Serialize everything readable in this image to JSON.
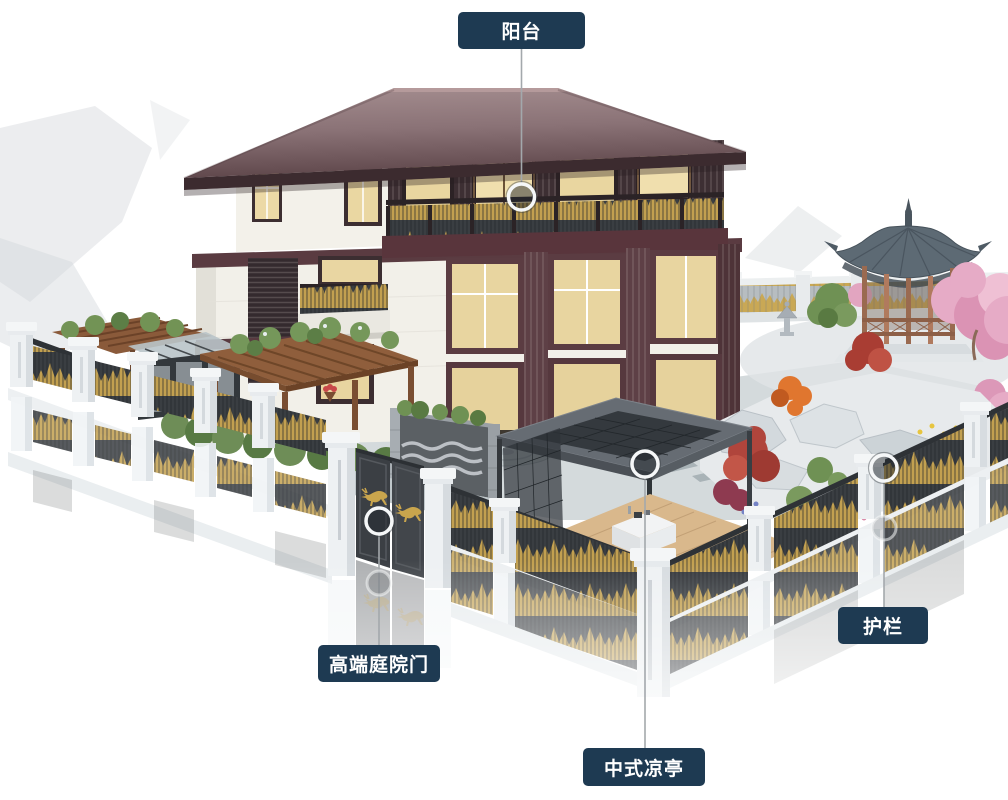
{
  "canvas": {
    "width": 1008,
    "height": 800,
    "background": "#ffffff"
  },
  "style": {
    "label_bg": "#1e3a52",
    "label_text": "#ffffff",
    "line_color": "#a3a8ac",
    "marker_ring": "#f5f7f8",
    "gold_accent": "#c2a050",
    "roof_color": "#7e686c",
    "fence_white": "#eef1f3"
  },
  "callouts": [
    {
      "id": "balcony",
      "label": "阳台",
      "target": "house-balcony"
    },
    {
      "id": "gate",
      "label": "高端庭院门",
      "target": "courtyard-gate"
    },
    {
      "id": "pavilion",
      "label": "中式凉亭",
      "target": "modern-pavilion"
    },
    {
      "id": "guardrail",
      "label": "护栏",
      "target": "stone-fence"
    }
  ]
}
